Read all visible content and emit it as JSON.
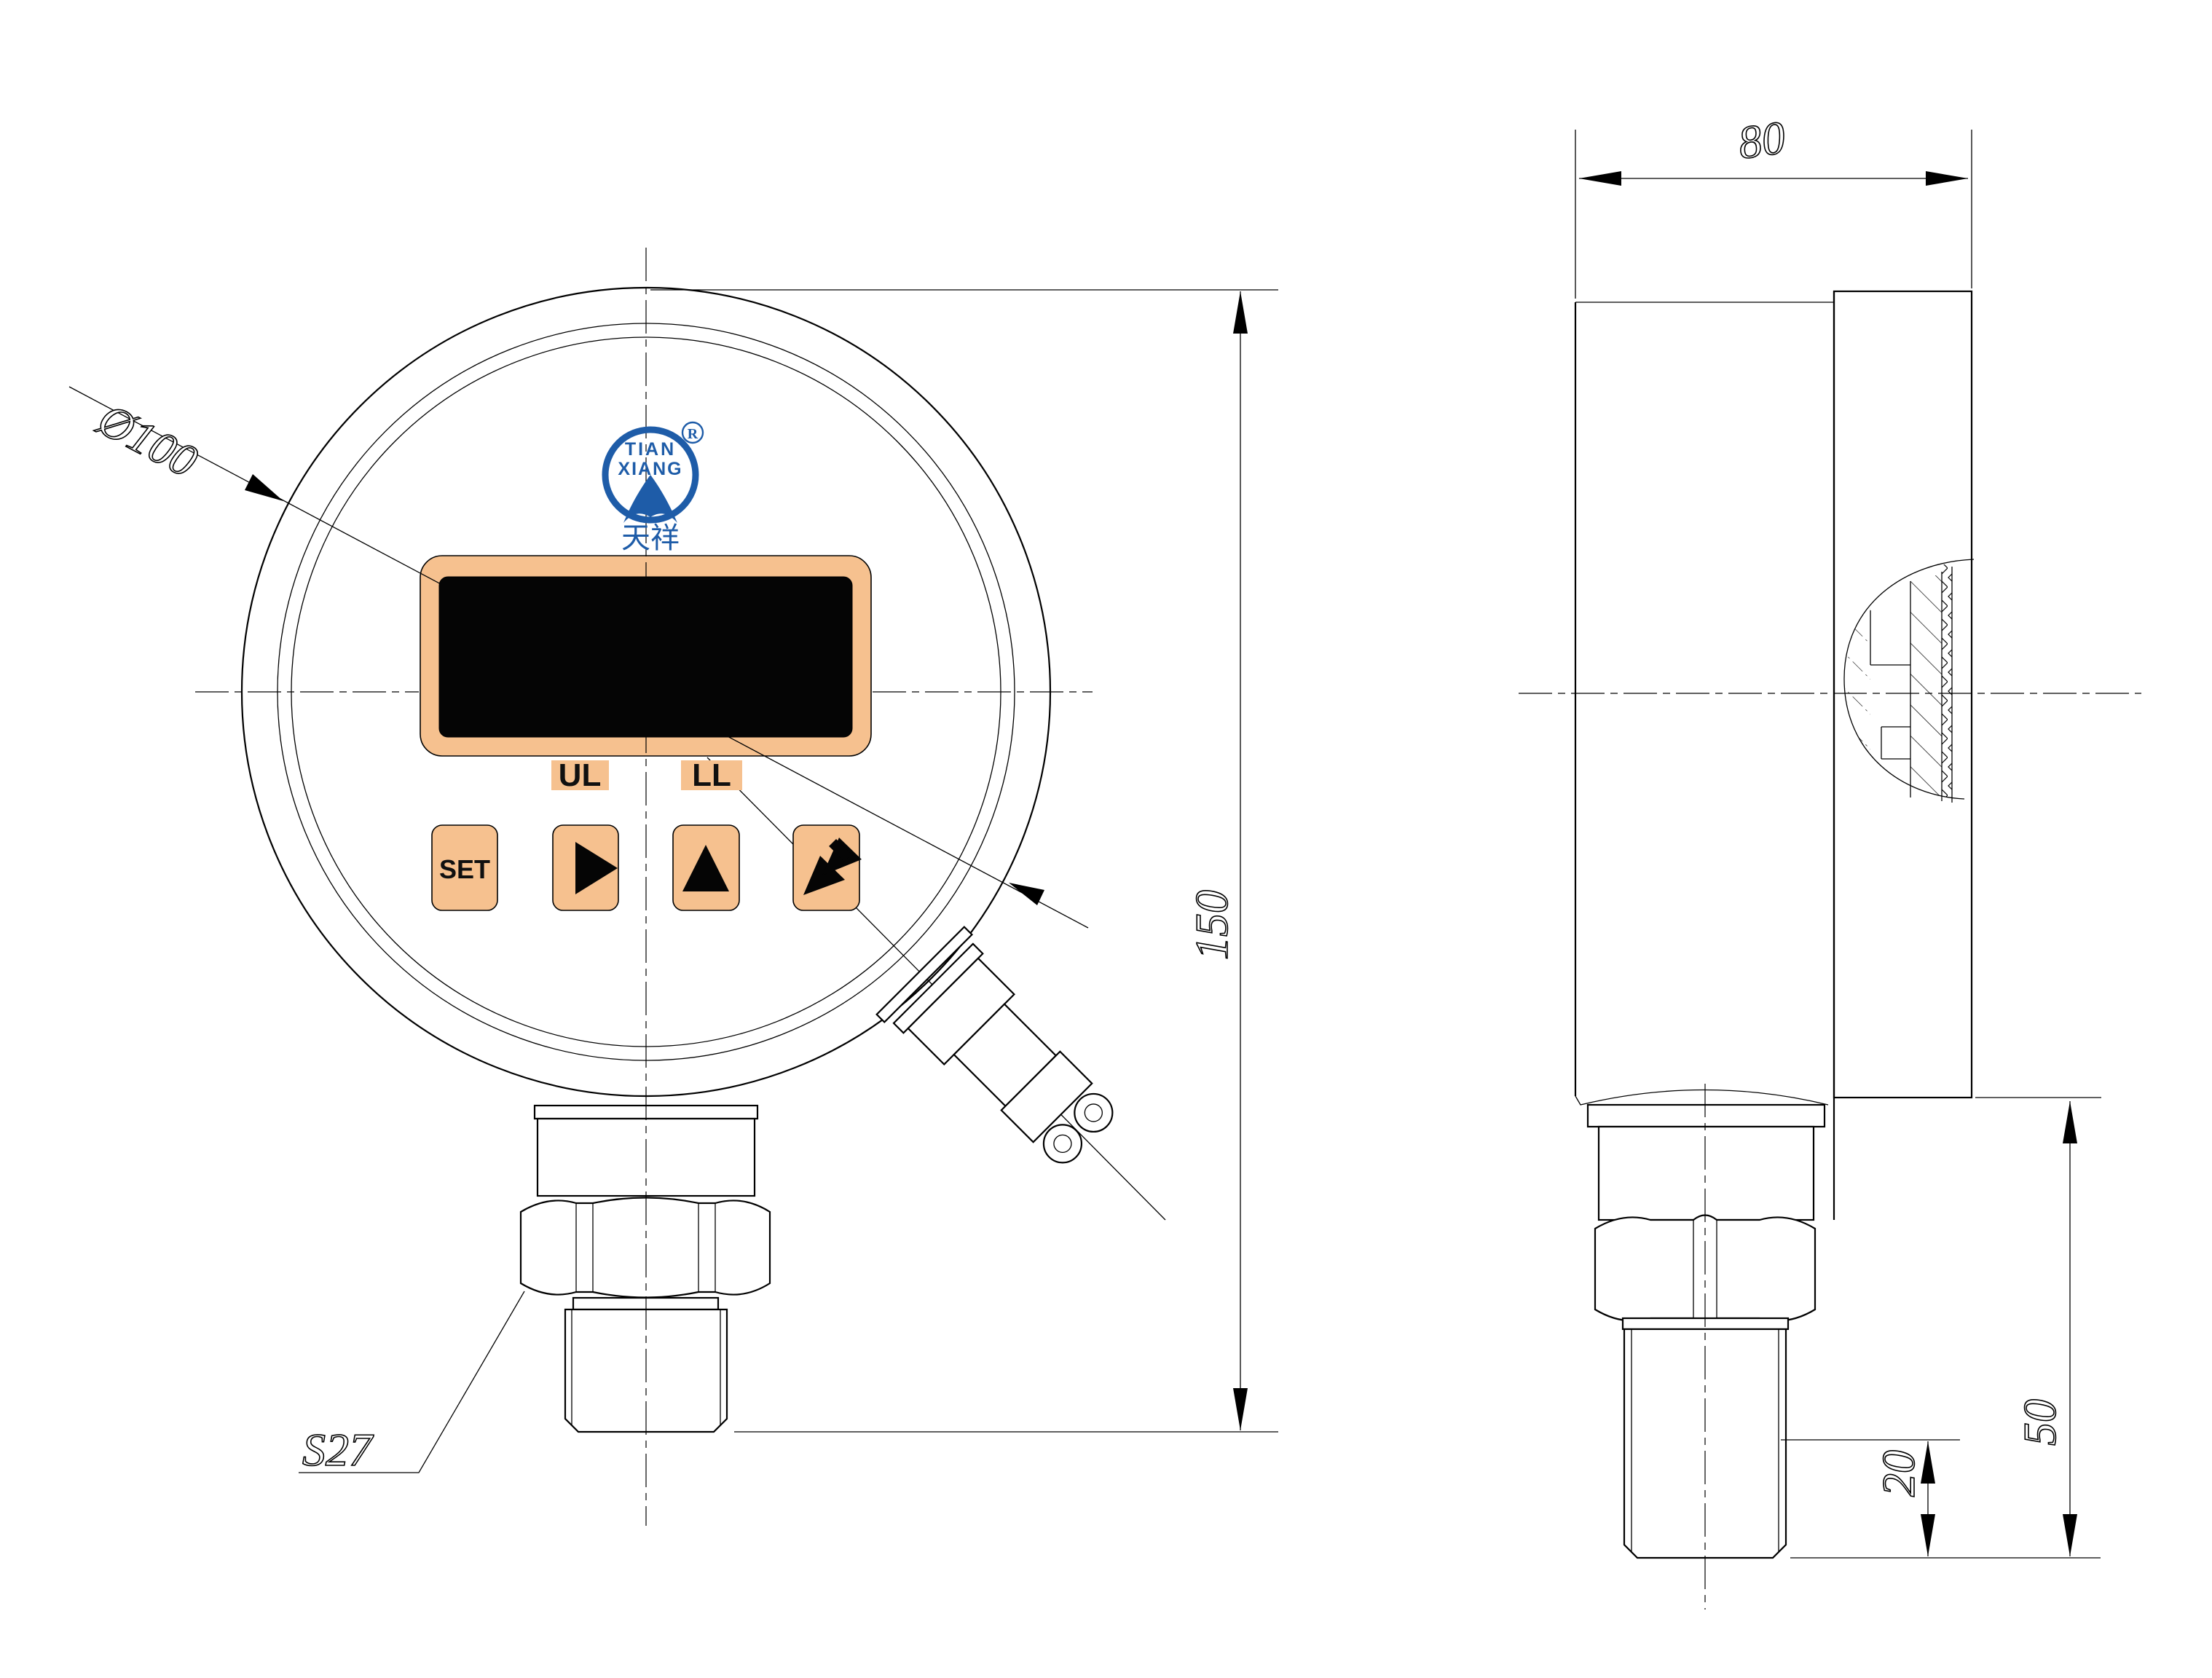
{
  "front_view": {
    "labels": {
      "diameter": "Ø100",
      "height": "150",
      "wrench": "S27"
    },
    "display": {
      "ul": "UL",
      "ll": "LL"
    },
    "buttons": {
      "set": "SET",
      "right_icon": "right-triangle",
      "up_icon": "up-triangle",
      "enter_icon": "double-down-left-arrow"
    },
    "logo": {
      "line1": "TIAN",
      "line2": "XIANG",
      "registered": "R",
      "chinese": "天祥"
    }
  },
  "side_view": {
    "labels": {
      "depth": "80",
      "lower_height": "50",
      "thread_length": "20"
    }
  },
  "colors": {
    "accent_orange": "#F6C18F",
    "display_black": "#050505",
    "logo_blue": "#1E5CA8",
    "line_black": "#000000"
  }
}
